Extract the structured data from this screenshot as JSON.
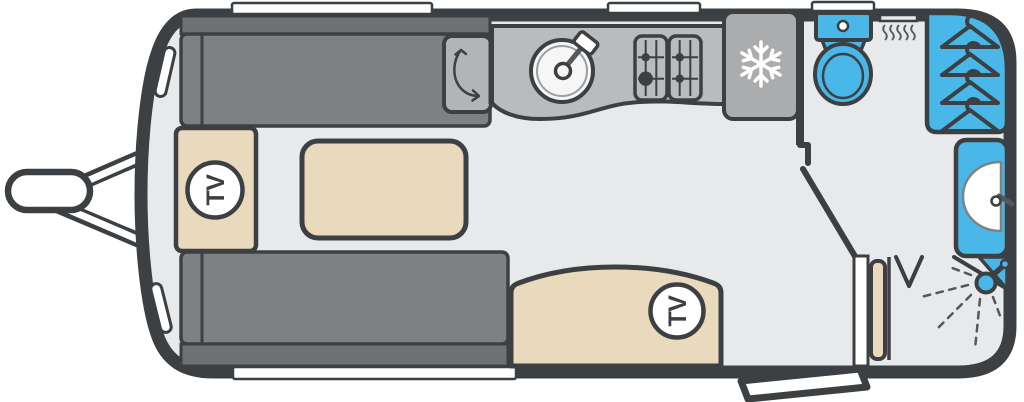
{
  "figure": {
    "type": "caravan-floorplan"
  },
  "labels": {
    "tv_front": "TV",
    "tv_rear": "TV"
  },
  "colors": {
    "outline": "#3d4043",
    "floor": "#e8e9eb",
    "white": "#ffffff",
    "sofa": "#7e8184",
    "sofa_back": "#6e7174",
    "cabinet": "#b2b4b6",
    "counter": "#b9bbbd",
    "fridge": "#aaacae",
    "beige": "#e9dabd",
    "blue": "#49b8e8",
    "accent": "#55585b",
    "sink": "#f6f6f6"
  },
  "icons": {
    "tv_badge": "circle with rotated TV label",
    "snowflake": "fridge-freezer snowflake",
    "hanger": "wardrobe coat hanger",
    "sink": "round sink with tap",
    "hob": "four-burner gas hob",
    "toilet": "toilet with cistern",
    "heater": "blown-air heater vent",
    "washbasin": "half-round basin with tap",
    "shower": "shower head with spray lines",
    "arrow": "curved swing arrow",
    "hitch": "tow hitch and A-frame",
    "step": "entrance step"
  }
}
